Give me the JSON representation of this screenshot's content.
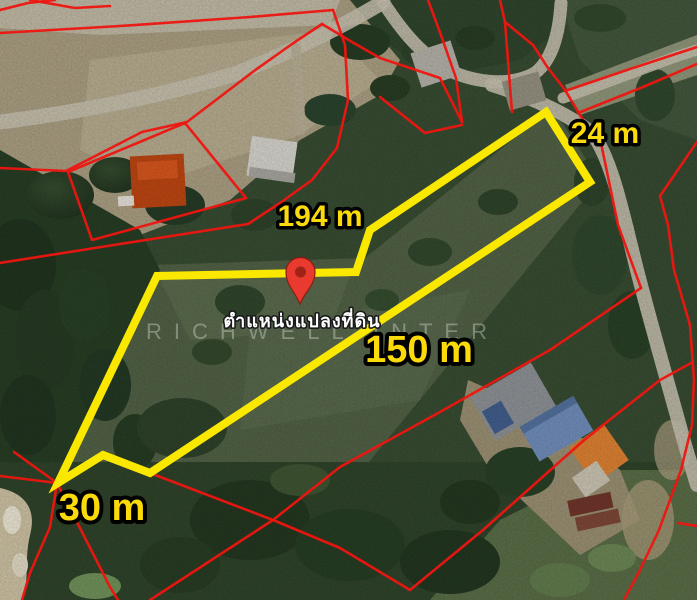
{
  "map": {
    "watermark": "RICHWELL INTER",
    "pin_caption": "ตำแหน่งแปลงที่ดิน",
    "labels": {
      "north": "194 m",
      "east": "24 m",
      "south": "150 m",
      "west": "30 m"
    },
    "colors": {
      "plot_boundary": "#fbe800",
      "parcel_line": "#ee1510",
      "label_fill": "#fada08",
      "pin": "#e83a2e"
    },
    "geometry": {
      "plot_boundary": "546,112 590,182 150,473 103,455 58,483 157,276 356,272 370,230",
      "parcel_lines": [
        "0,33 120,26 250,17 333,10",
        "333,10 345,45 348,100 337,148 312,180 280,203 248,224 120,244 0,263",
        "0,168 66,171 142,132 187,122 254,71 292,44 322,24",
        "68,172 185,123 246,198 92,240 68,172",
        "0,10 28,3 55,0",
        "30,0 75,8 110,6",
        "322,24 352,42 380,58",
        "380,58 440,78 462,122",
        "428,0 442,38 456,78 462,122",
        "380,97 425,133 462,125",
        "500,0 505,22",
        "505,22 512,112",
        "505,22 533,45 548,68 565,90",
        "565,90 583,120 601,143 618,225 641,288",
        "641,288 550,350 440,412 340,467 273,520 150,600",
        "150,473 273,520 340,548 410,590",
        "410,590 483,530 583,441 660,380 693,362",
        "697,142 660,196 668,225 674,270 690,325",
        "690,325 694,380 692,425 681,470 659,530 639,572 624,600",
        "565,91 627,70 697,47",
        "578,113 643,87 697,64",
        "0,476 57,483",
        "14,452 57,483",
        "57,483 50,527 30,573 22,600",
        "57,483 110,587 118,600",
        "678,523 697,526"
      ]
    }
  }
}
